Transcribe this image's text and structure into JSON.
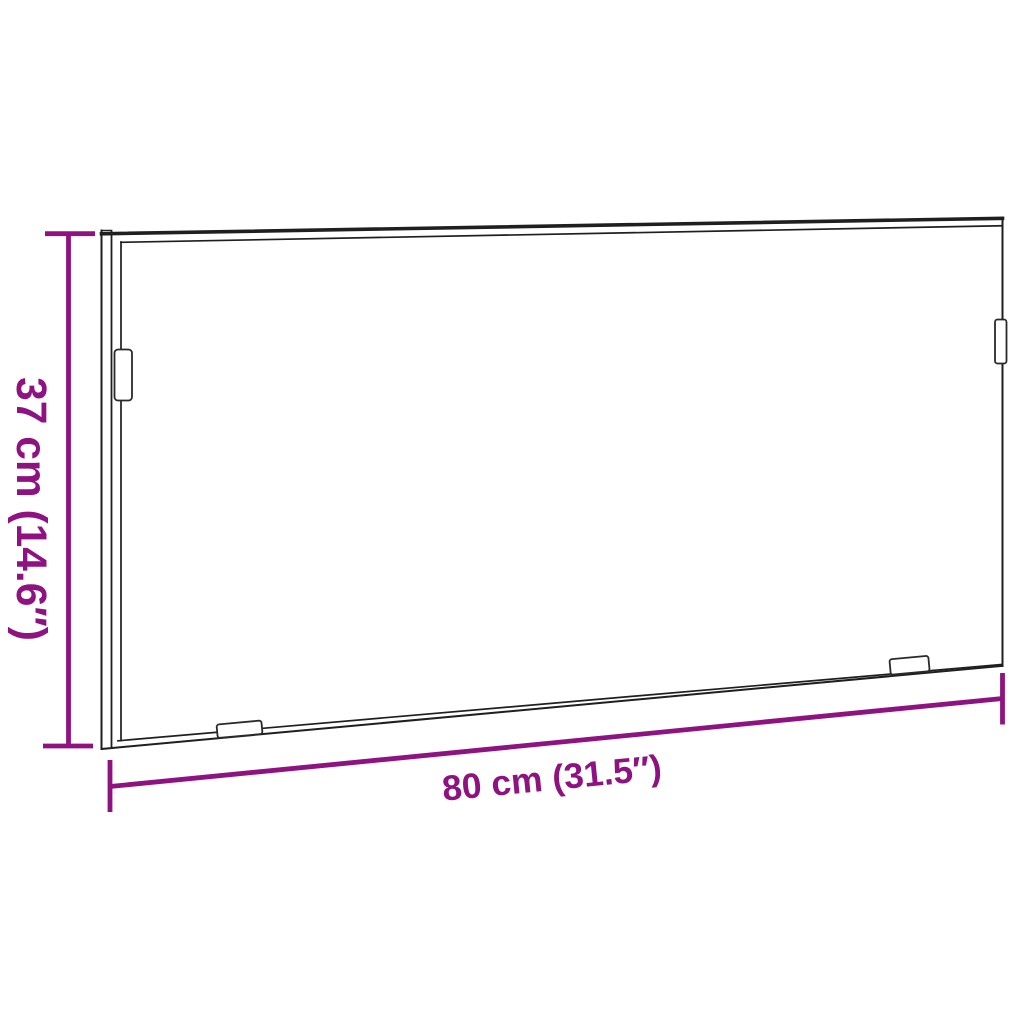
{
  "diagram": {
    "kind": "product-dimension-diagram",
    "subject": "rectangular frame with mounting clips",
    "accent_color": "#8E1380",
    "outline_color": "#1f1f1f",
    "background_color": "#ffffff",
    "height_dimension": {
      "label": "37 cm (14.6″)",
      "value_cm": 37,
      "value_inches": 14.6
    },
    "width_dimension": {
      "label": "80 cm (31.5″)",
      "value_cm": 80,
      "value_inches": 31.5
    }
  }
}
